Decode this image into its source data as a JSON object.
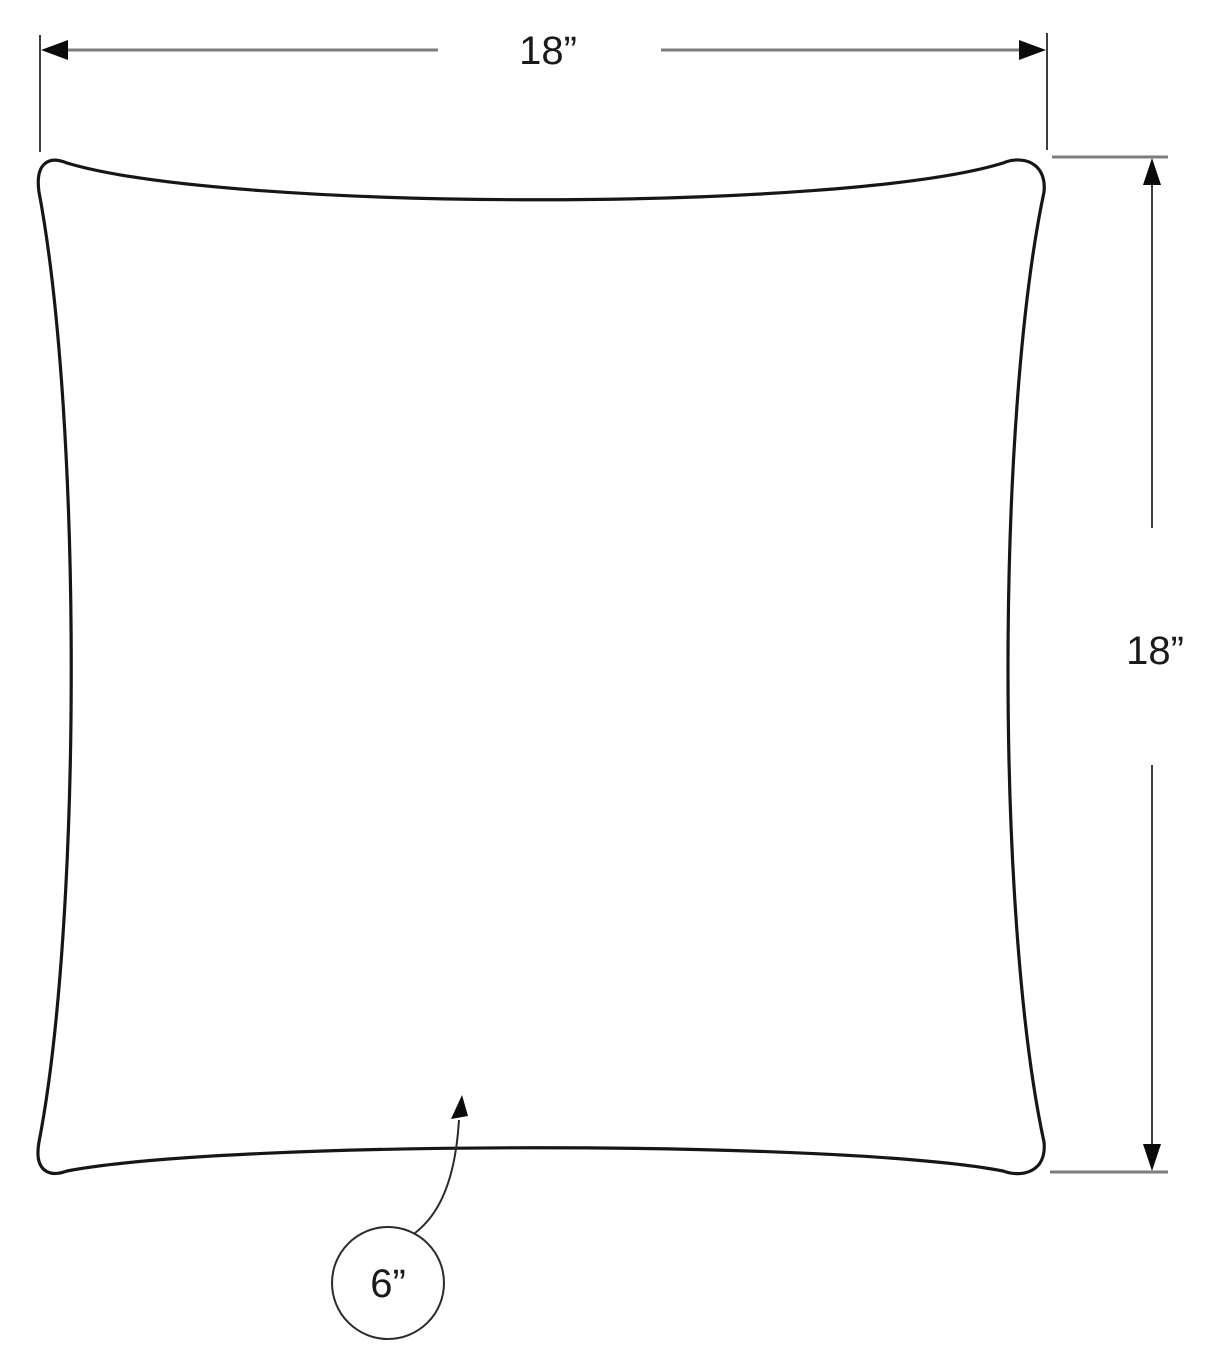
{
  "diagram": {
    "kind": "pillow-dimension-drawing",
    "labels": {
      "width": "18”",
      "height": "18”",
      "callout": "6”"
    },
    "colors": {
      "outline": "#161616",
      "dimension_line": "#7d7d7d",
      "extension_line": "#3d3d3d",
      "arrowhead": "#0b0b0b",
      "callout_line": "#2b2b2b",
      "label_text": "#1a1a1a",
      "background": "#ffffff"
    }
  }
}
